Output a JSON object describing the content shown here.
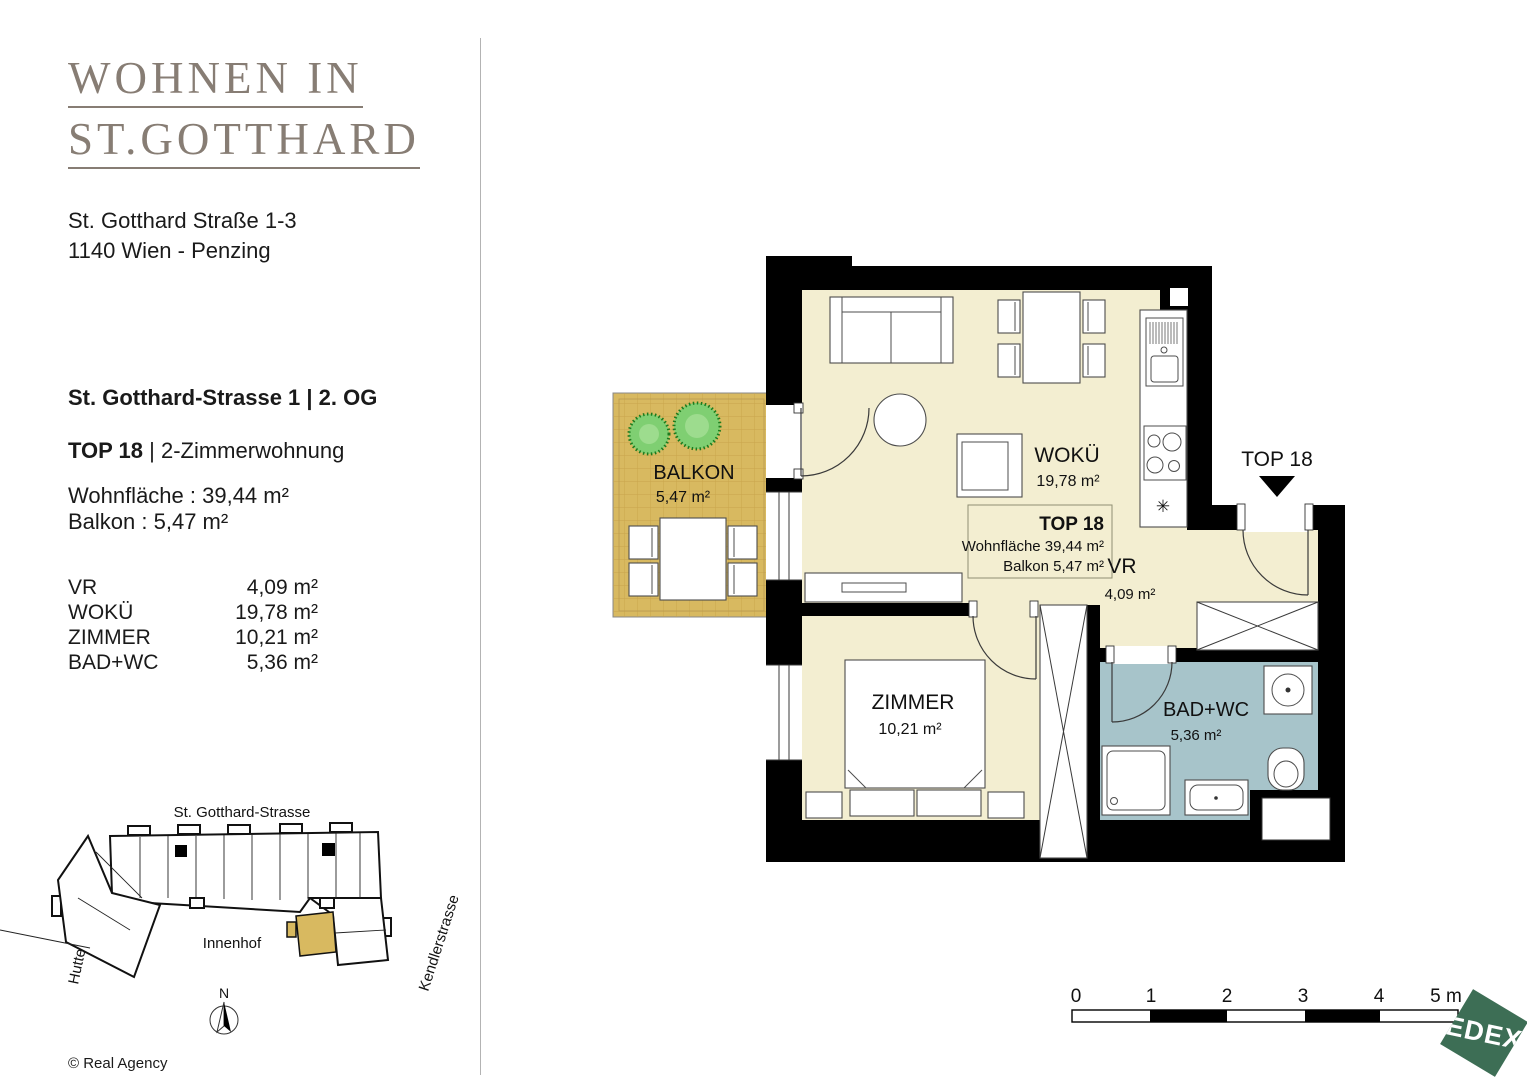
{
  "brand": {
    "title_line1": "WOHNEN IN",
    "title_line2": "ST.GOTTHARD"
  },
  "address": {
    "line1": "St. Gotthard Straße 1-3",
    "line2": "1140 Wien - Penzing"
  },
  "details": {
    "location": "St. Gotthard-Strasse 1 | 2. OG",
    "unit_bold": "TOP 18",
    "unit_rest": "| 2-Zimmerwohnung",
    "living_area": "Wohnfläche : 39,44 m²",
    "balcony_area": "Balkon : 5,47 m²"
  },
  "rooms": [
    {
      "name": "VR",
      "area": "4,09 m²"
    },
    {
      "name": "WOKÜ",
      "area": "19,78 m²"
    },
    {
      "name": "ZIMMER",
      "area": "10,21 m²"
    },
    {
      "name": "BAD+WC",
      "area": "5,36 m²"
    }
  ],
  "floorplan": {
    "balkon": {
      "name": "BALKON",
      "area": "5,47 m²"
    },
    "woku": {
      "name": "WOKÜ",
      "area": "19,78 m²"
    },
    "zimmer": {
      "name": "ZIMMER",
      "area": "10,21 m²"
    },
    "bad": {
      "name": "BAD+WC",
      "area": "5,36 m²"
    },
    "vr": {
      "name": "VR",
      "area": "4,09 m²"
    },
    "entrance_label": "TOP 18",
    "infobox": {
      "title": "TOP 18",
      "line1": "Wohnfläche 39,44 m²",
      "line2": "Balkon 5,47 m²"
    },
    "boiler_symbol": "✳"
  },
  "siteplan": {
    "street_top": "St. Gotthard-Strasse",
    "street_left": "Huttengasse",
    "street_right": "Kendlerstrasse",
    "courtyard": "Innenhof",
    "north": "N"
  },
  "scalebar": {
    "ticks": [
      "0",
      "1",
      "2",
      "3",
      "4",
      "5 m"
    ]
  },
  "logo": {
    "text": "EDEX"
  },
  "copyright": "© Real Agency",
  "colors": {
    "cream": "#f3eed1",
    "balcony": "#d8b960",
    "bath": "#a7c4ca",
    "wall": "#000000",
    "logo_green": "#3d6e55",
    "title": "#877d74"
  }
}
